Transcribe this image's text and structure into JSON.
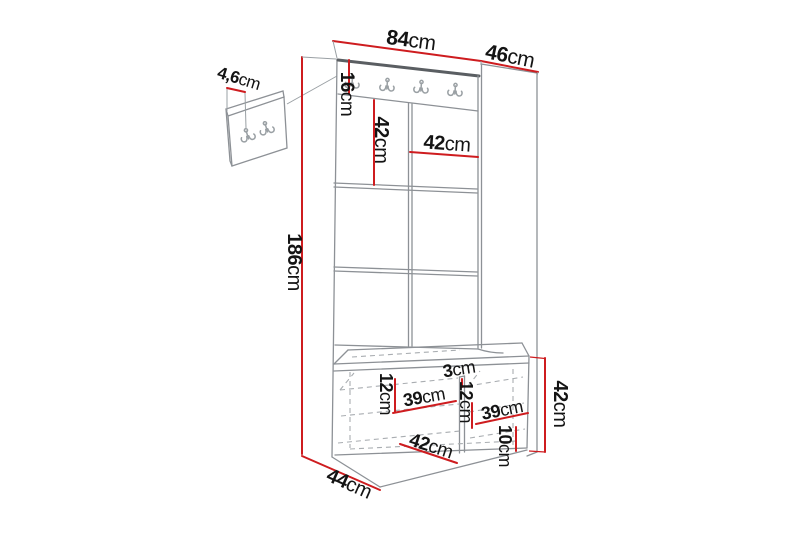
{
  "title": "Hallway furniture set dimension diagram",
  "dims": {
    "width_top": {
      "num": "84",
      "unit": "cm"
    },
    "depth_top": {
      "num": "46",
      "unit": "cm"
    },
    "wall_panel_depth": {
      "num": "4,6",
      "unit": "cm"
    },
    "rail_height": {
      "num": "16",
      "unit": "cm"
    },
    "panel_height": {
      "num": "42",
      "unit": "cm"
    },
    "panel_width": {
      "num": "42",
      "unit": "cm"
    },
    "total_height": {
      "num": "186",
      "unit": "cm"
    },
    "bench_top_offset_left": {
      "num": "12",
      "unit": "cm"
    },
    "bench_inner_width_left": {
      "num": "39",
      "unit": "cm"
    },
    "bench_divider": {
      "num": "3",
      "unit": "cm"
    },
    "bench_top_offset_right": {
      "num": "12",
      "unit": "cm"
    },
    "bench_inner_width_right": {
      "num": "39",
      "unit": "cm"
    },
    "bench_inner_depth": {
      "num": "42",
      "unit": "cm"
    },
    "bench_floor_clearance": {
      "num": "10",
      "unit": "cm"
    },
    "bench_height": {
      "num": "42",
      "unit": "cm"
    },
    "base_depth": {
      "num": "44",
      "unit": "cm"
    }
  },
  "icons": {
    "coat_hook": "double-prong-coat-hook"
  },
  "colors": {
    "dimension_red": "#ce1c1f",
    "structure_gray": "#8d9196",
    "edge_dark": "#5a5e62",
    "hidden_dash_gray": "#a9adb1",
    "text_black": "#141414"
  }
}
